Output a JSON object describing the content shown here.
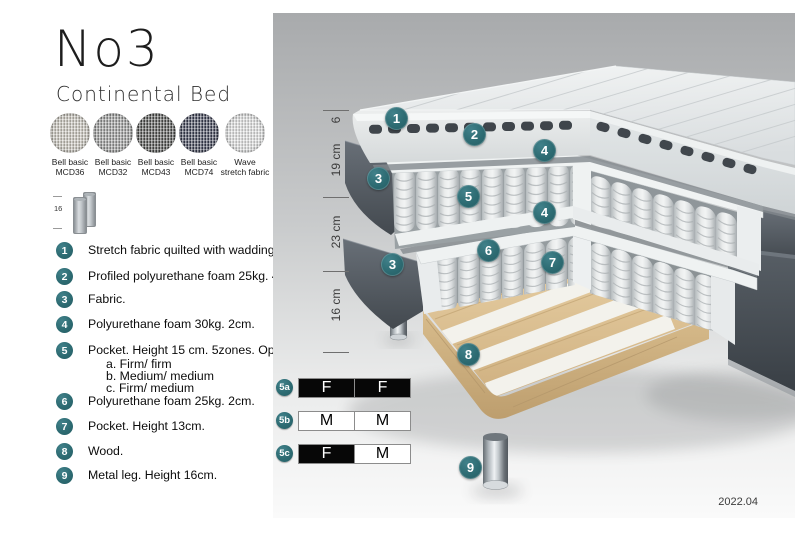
{
  "header": {
    "title": "No3",
    "subtitle": "Continental Bed"
  },
  "swatches": [
    {
      "line1": "Bell basic",
      "line2": "MCD36",
      "color": "#cdc9bf"
    },
    {
      "line1": "Bell basic",
      "line2": "MCD32",
      "color": "#9d9e9d"
    },
    {
      "line1": "Bell basic",
      "line2": "MCD43",
      "color": "#525351"
    },
    {
      "line1": "Bell basic",
      "line2": "MCD74",
      "color": "#3e4257"
    },
    {
      "line1": "Wave",
      "line2": "stretch fabric",
      "color": "#e8e9e9"
    }
  ],
  "leg_icon": {
    "height_label": "16"
  },
  "legend": {
    "items": [
      {
        "num": "1",
        "text": "Stretch fabric quilted with wadding."
      },
      {
        "num": "2",
        "text": "Profiled polyurethane foam 25kg. 4cm."
      },
      {
        "num": "3",
        "text": "Fabric."
      },
      {
        "num": "4",
        "text": "Polyurethane foam 30kg. 2cm."
      },
      {
        "num": "5",
        "text": "Pocket. Height 15 cm. 5zones. Option:",
        "options": [
          "a. Firm/ firm",
          "b. Medium/ medium",
          "c. Firm/ medium"
        ]
      },
      {
        "num": "6",
        "text": "Polyurethane foam 25kg. 2cm."
      },
      {
        "num": "7",
        "text": "Pocket. Height 13cm."
      },
      {
        "num": "8",
        "text": "Wood."
      },
      {
        "num": "9",
        "text": "Metal leg. Height 16cm."
      }
    ]
  },
  "diagram": {
    "dimensions": [
      "6",
      "19 cm",
      "23 cm",
      "16 cm"
    ],
    "callouts": [
      {
        "label": "1"
      },
      {
        "label": "2"
      },
      {
        "label": "4"
      },
      {
        "label": "3"
      },
      {
        "label": "5"
      },
      {
        "label": "4"
      },
      {
        "label": "6"
      },
      {
        "label": "7"
      },
      {
        "label": "3"
      },
      {
        "label": "8"
      },
      {
        "label": "9"
      }
    ],
    "firmness": {
      "rows": [
        {
          "id": "5a",
          "cells": [
            {
              "text": "F",
              "variant": "dark"
            },
            {
              "text": "F",
              "variant": "dark"
            }
          ]
        },
        {
          "id": "5b",
          "cells": [
            {
              "text": "M",
              "variant": "light"
            },
            {
              "text": "M",
              "variant": "light"
            }
          ]
        },
        {
          "id": "5c",
          "cells": [
            {
              "text": "F",
              "variant": "dark"
            },
            {
              "text": "M",
              "variant": "light"
            }
          ]
        }
      ]
    },
    "version": "2022.04"
  },
  "colors": {
    "badge_teal": "#2e6f76",
    "fabric_dark": "#51575e",
    "wood": "#d8bd8f",
    "spring": "#e4e7e7"
  }
}
